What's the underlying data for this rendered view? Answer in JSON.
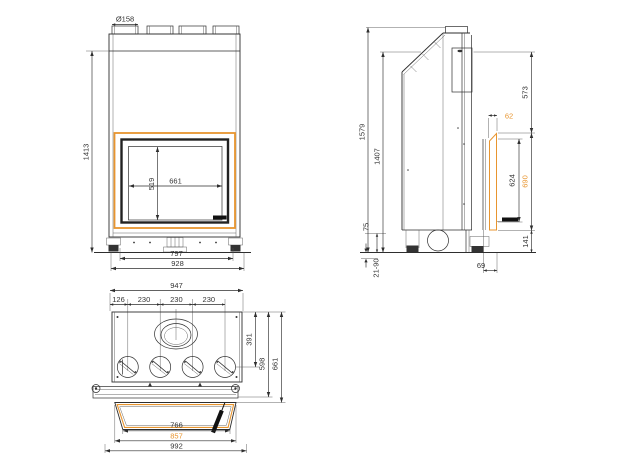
{
  "front": {
    "flue_diameter": "Ø158",
    "overall_height": "1413",
    "glass_width": "661",
    "glass_height": "519",
    "base_width": "797",
    "body_width": "928"
  },
  "side": {
    "overall_height": "1579",
    "body_height": "1407",
    "top_to_frame": "573",
    "frame_projection": "62",
    "door_height": "624",
    "frame_height": "690",
    "base_height": "141",
    "plinth_height": "75",
    "feet_range": "21-90",
    "foot_depth": "69"
  },
  "plan": {
    "body_width": "947",
    "pitch_1": "126",
    "pitch_2": "230",
    "pitch_3": "230",
    "pitch_4": "230",
    "flue_depth": "391",
    "front_depth": "598",
    "glass_depth": "661",
    "glass_width": "766",
    "frame_width": "857",
    "overall_width": "992"
  },
  "colors": {
    "accent": "#E8952F",
    "line": "#2E2E2E"
  }
}
